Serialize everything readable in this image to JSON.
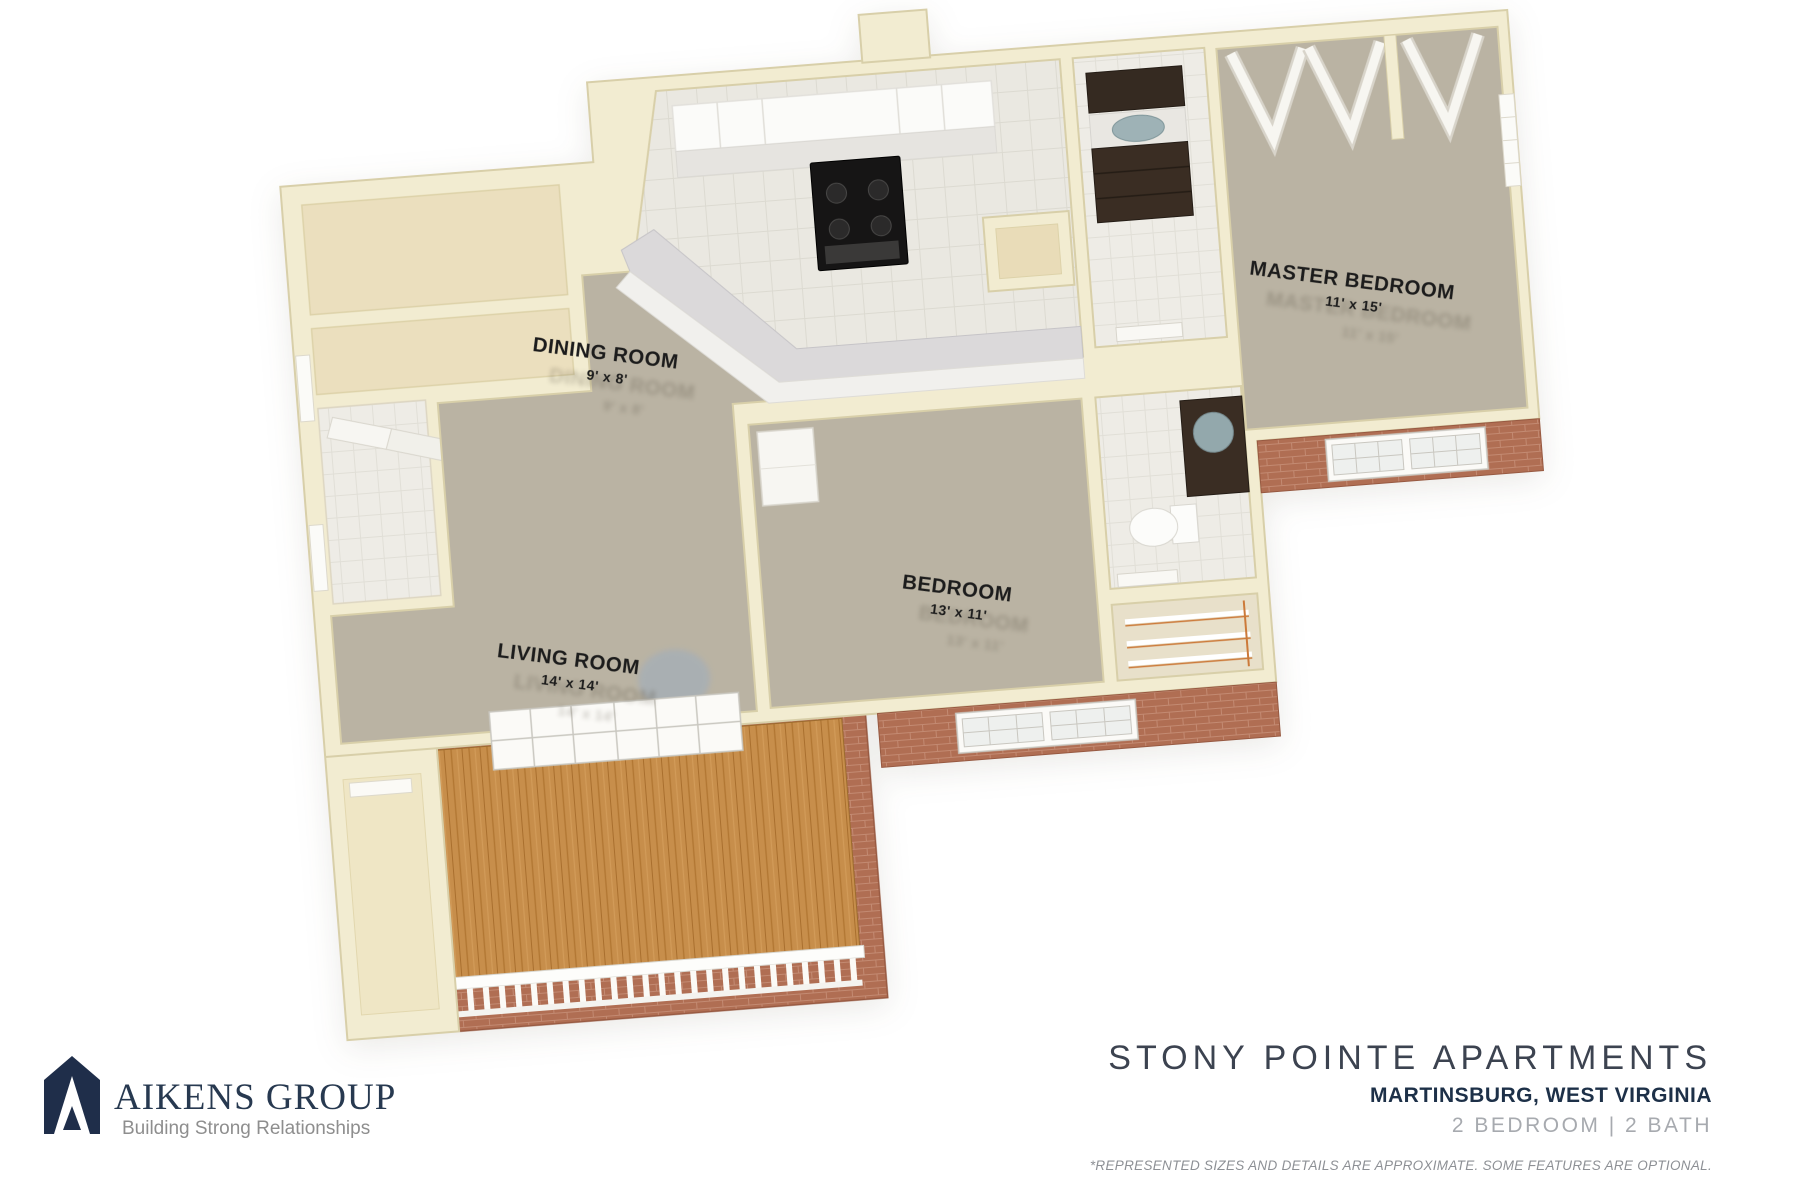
{
  "floorplan": {
    "rooms": [
      {
        "name": "DINING ROOM",
        "dims": "9' x 8'"
      },
      {
        "name": "LIVING ROOM",
        "dims": "14' x 14'"
      },
      {
        "name": "BEDROOM",
        "dims": "13' x 11'"
      },
      {
        "name": "MASTER BEDROOM",
        "dims": "11' x 15'"
      }
    ],
    "features": [
      "kitchen",
      "master-bathroom",
      "bathroom",
      "entry-closets",
      "master-bifold-closets",
      "bedroom-closet",
      "pantry-closet",
      "laundry-closet",
      "balcony-porch",
      "porch-railing",
      "exterior-brick",
      "windows"
    ]
  },
  "branding": {
    "logo_name": "AIKENS GROUP",
    "tagline": "Building Strong Relationships"
  },
  "property": {
    "name": "STONY POINTE APARTMENTS",
    "location": "MARTINSBURG, WEST VIRGINIA",
    "configuration": "2 BEDROOM | 2 BATH",
    "disclaimer": "*REPRESENTED SIZES AND DETAILS ARE APPROXIMATE. SOME FEATURES ARE OPTIONAL."
  },
  "colors": {
    "wall_cream": "#f2ecd1",
    "carpet": "#bab3a3",
    "kitchen_tile": "#eae8e1",
    "brick": "#b06e53",
    "porch_wood": "#c78e4b",
    "vanity_brown": "#3a2d23",
    "logo_navy": "#1f2e4a",
    "title_slate": "#3c4350",
    "muted_gray": "#a7aaaf"
  }
}
